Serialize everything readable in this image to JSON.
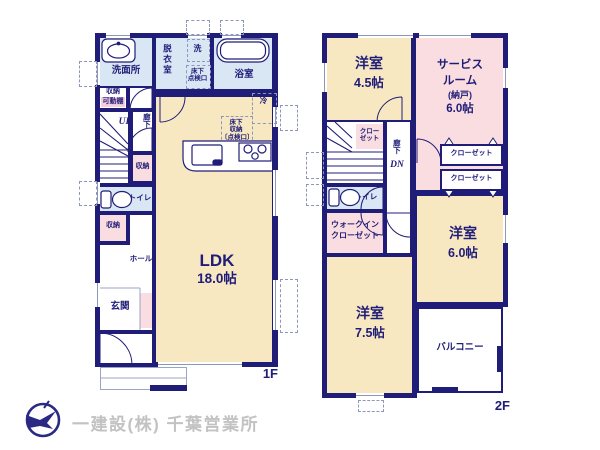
{
  "colors": {
    "wall": "#201d78",
    "beige": "#f7e8c2",
    "pink": "#fadde0",
    "blue": "#d9e6f4",
    "badge_pink": "#f5cfe0",
    "logo": "#2a2a85",
    "footer_gray": "#c2c2c2"
  },
  "f1": {
    "label": "1F",
    "washroom": "洗面所",
    "storage_top": "収納",
    "movable_shelf": "可動棚",
    "dressing_room": "脱衣室",
    "washer": "洗",
    "hatch_line1": "床下",
    "hatch_line2": "点検口",
    "bathroom": "浴室",
    "fridge": "冷",
    "ufs_line1": "床下",
    "ufs_line2": "収納",
    "ufs_line3": "〔点検口〕",
    "up": "UP",
    "corridor": "廊下",
    "storage_mid": "収納",
    "toilet": "トイレ",
    "storage_low": "収納",
    "hall": "ホール",
    "entrance": "玄関",
    "ldk": "LDK",
    "ldk_size": "18.0帖"
  },
  "f2": {
    "label": "2F",
    "room45": "洋室",
    "room45_size": "4.5帖",
    "service_line1": "サービス",
    "service_line2": "ルーム",
    "service_line3": "(納戸)",
    "service_size": "6.0帖",
    "closet_small_line1": "クロー",
    "closet_small_line2": "ゼット",
    "corridor": "廊下",
    "dn": "DN",
    "toilet": "トイレ",
    "closet1": "クローゼット",
    "closet2": "クローゼット",
    "wic_line1": "ウォークイン",
    "wic_line2": "クローゼット",
    "room60": "洋室",
    "room60_size": "6.0帖",
    "room75": "洋室",
    "room75_size": "7.5帖",
    "balcony": "バルコニー"
  },
  "footer": {
    "company": "一建設(株) 千葉営業所"
  }
}
